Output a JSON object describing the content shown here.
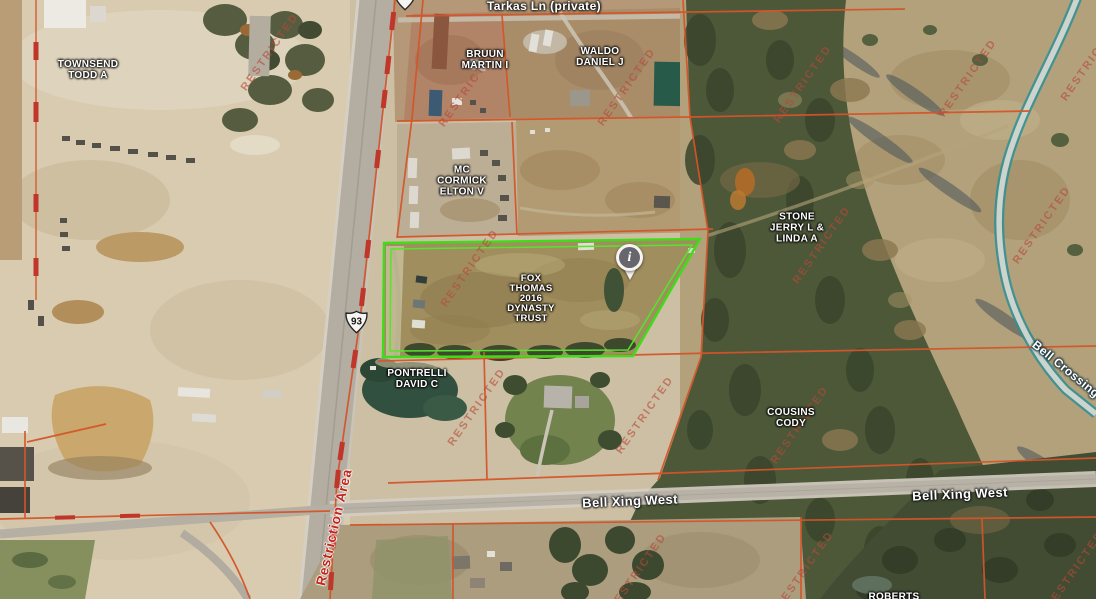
{
  "map_title": "Parcel map aerial view",
  "labels": {
    "tarkas_ln": "Tarkas Ln (private)",
    "townsend": "TOWNSEND\nTODD A",
    "bruun": "BRUUN\nMARTIN I",
    "waldo": "WALDO\nDANIEL J",
    "mccormick": "MC\nCORMICK\nELTON V",
    "stone": "STONE\nJERRY L &\nLINDA A",
    "fox": "FOX\nTHOMAS\n2016\nDYNASTY\nTRUST",
    "pontrelli": "PONTRELLI\nDAVID C",
    "cousins": "COUSINS\nCODY",
    "roberts": "ROBERTS",
    "bell_xing_west": "Bell Xing West",
    "bell_crossing": "Bell Crossing",
    "restriction_area": "Restriction Area",
    "watermark": "RESTRICTED",
    "route_shield": "93",
    "marker_glyph": "i"
  },
  "colors": {
    "parcel_line": "#d4552a",
    "restriction_dash": "#c0362a",
    "selected_parcel_outline": "#46df1c",
    "watermark": "#b7483a",
    "restriction_text": "#c1261b",
    "water_line": "#2e8f96",
    "marker_fill": "#67666d"
  }
}
